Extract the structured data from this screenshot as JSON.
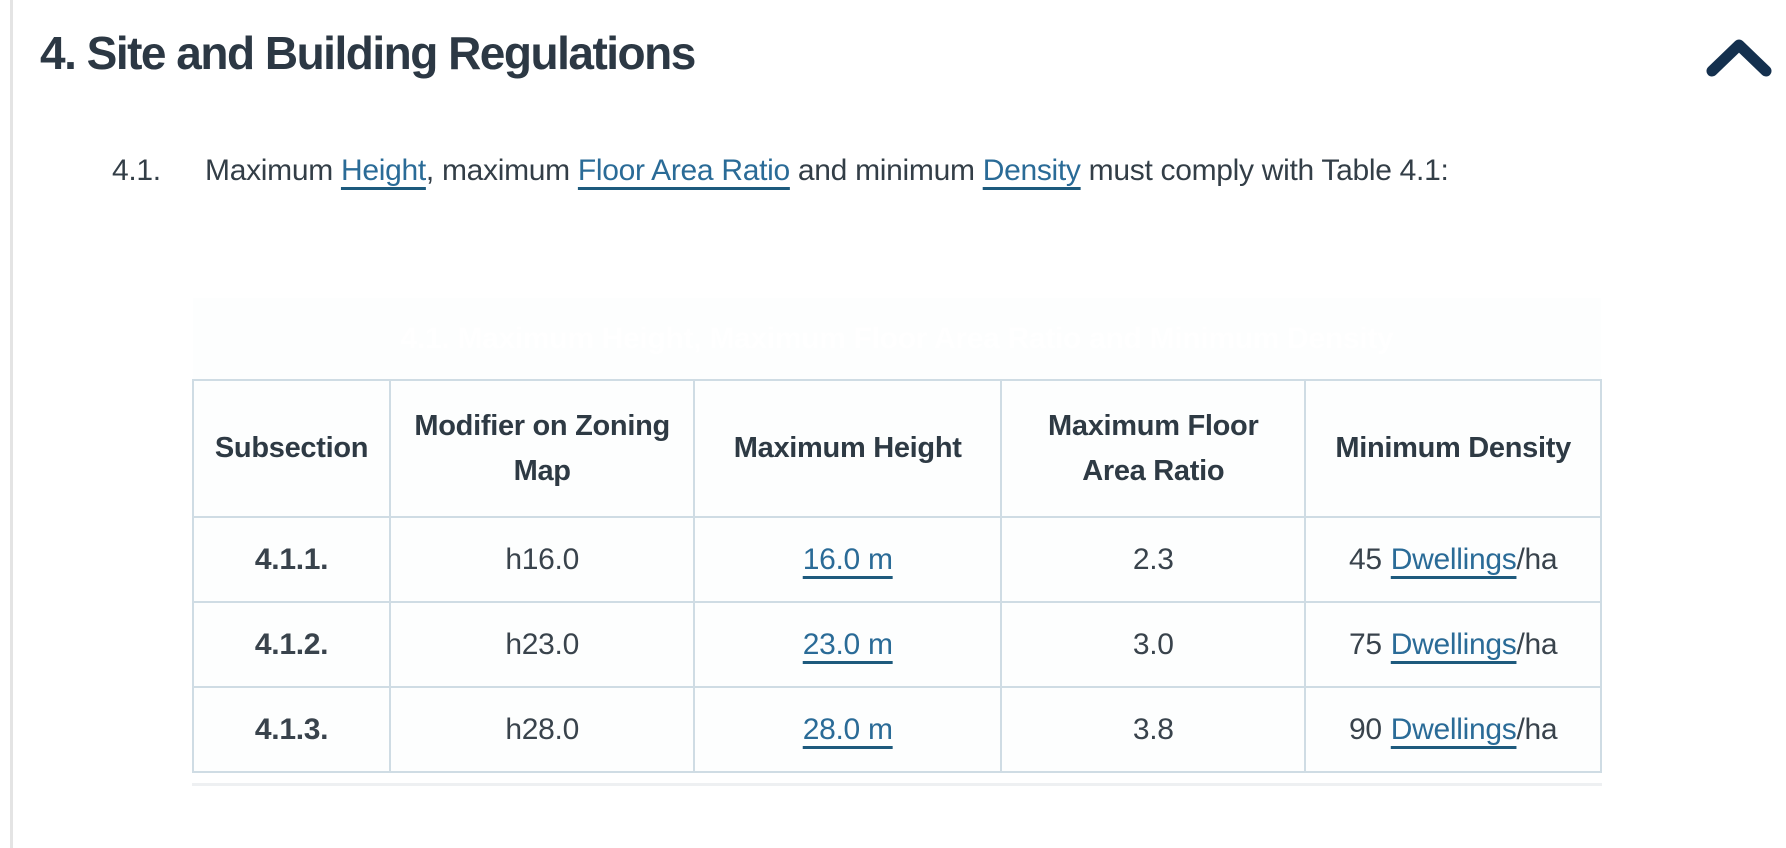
{
  "colors": {
    "table_header_navy": "#1c3a5e",
    "heading_text": "#2c3844",
    "body_text": "#333e47",
    "link_blue": "#2a6b97",
    "link_underline": "#1d5a7d",
    "table_border": "#cfdce4",
    "chevron_navy": "#14304e"
  },
  "header": {
    "title": "4. Site and Building Regulations",
    "collapse_icon": "chevron-up-icon"
  },
  "clause": {
    "number": "4.1.",
    "parts": [
      "Maximum ",
      "Height",
      ", maximum ",
      "Floor Area Ratio",
      " and minimum ",
      "Density",
      " must comply with Table 4.1:"
    ]
  },
  "table": {
    "title": "4.1. Maximum Height, Maximum Floor Area Ratio and Minimum Density",
    "columns": [
      "Subsection",
      "Modifier on Zoning Map",
      "Maximum Height",
      "Maximum Floor Area Ratio",
      "Minimum Density"
    ],
    "rows": [
      {
        "subsection": "4.1.1.",
        "modifier": "h16.0",
        "max_height": "16.0 m",
        "floor_area_ratio": "2.3",
        "density_value": "45",
        "density_link": "Dwellings",
        "density_unit": "/ha"
      },
      {
        "subsection": "4.1.2.",
        "modifier": "h23.0",
        "max_height": "23.0 m",
        "floor_area_ratio": "3.0",
        "density_value": "75",
        "density_link": "Dwellings",
        "density_unit": "/ha"
      },
      {
        "subsection": "4.1.3.",
        "modifier": "h28.0",
        "max_height": "28.0 m",
        "floor_area_ratio": "3.8",
        "density_value": "90",
        "density_link": "Dwellings",
        "density_unit": "/ha"
      }
    ]
  }
}
